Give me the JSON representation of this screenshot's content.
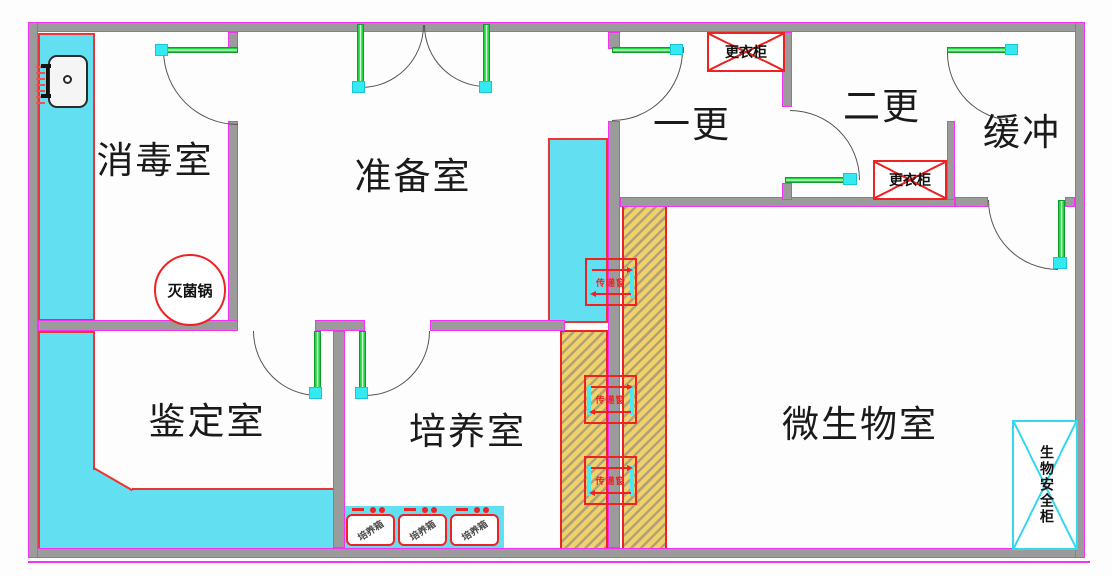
{
  "drawing": {
    "type": "laboratory floor plan",
    "rooms": [
      {
        "name": "消毒室"
      },
      {
        "name": "准备室"
      },
      {
        "name": "一更"
      },
      {
        "name": "二更"
      },
      {
        "name": "缓冲"
      },
      {
        "name": "鉴定室"
      },
      {
        "name": "培养室"
      },
      {
        "name": "微生物室"
      }
    ],
    "equipment": {
      "sterilizer": "灭菌锅",
      "wardrobe": "更衣柜",
      "pass_window": "传递窗",
      "incubator": "培养箱",
      "biosafety_cabinet": "生物安全柜"
    },
    "colors": {
      "wall_fill": "#9b9b9b",
      "wall_outline": "#f531f5",
      "counter_fill": "#63dff2",
      "counter_border": "#ee3333",
      "door_leaf": "#23d341",
      "hinge": "#35e9f2",
      "hatch_bg": "#f1d169",
      "hatch_stripe": "#b1a277",
      "equipment_red": "#ee2222",
      "cabinet_cyan": "#35d8ee"
    }
  }
}
